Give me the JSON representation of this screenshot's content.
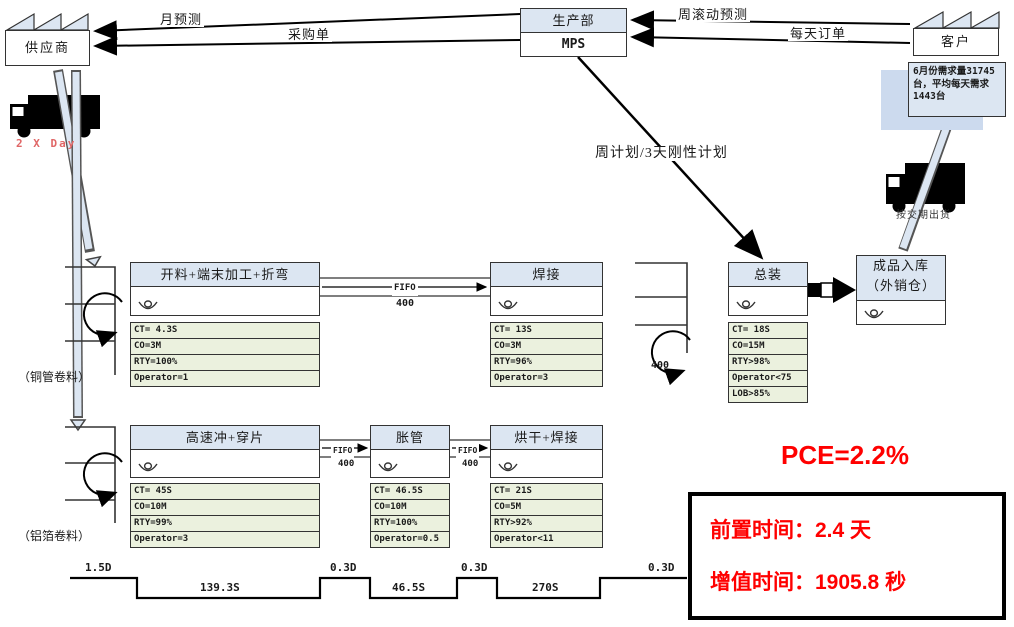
{
  "entities": {
    "supplier": "供应商",
    "production_dept": "生产部",
    "mps": "MPS",
    "customer": "客户",
    "demand_note": "6月份需求量31745台，平均每天需求1443台",
    "warehouse_line1": "成品入库",
    "warehouse_line2": "（外销仓）"
  },
  "flows": {
    "monthly_forecast": "月预测",
    "purchase_order": "采购单",
    "weekly_rolling_forecast": "周滚动预测",
    "daily_order": "每天订单",
    "weekly_plan": "周计划/3天刚性计划",
    "supplier_delivery_freq": "2 X Day",
    "ship_by_due_date": "按交期出货"
  },
  "inventory": {
    "copper_coil": "（铜管卷料）",
    "aluminum_coil": "（铝箔卷料）",
    "loop_qty": "400"
  },
  "fifo": {
    "label": "FIFO",
    "qty": "400"
  },
  "processes": [
    {
      "name": "开料+端末加工+折弯",
      "metrics": [
        "CT= 4.3S",
        "CO=3M",
        "RTY=100%",
        "Operator=1"
      ]
    },
    {
      "name": "焊接",
      "metrics": [
        "CT= 13S",
        "CO=3M",
        "RTY=96%",
        "Operator=3"
      ]
    },
    {
      "name": "总装",
      "metrics": [
        "CT= 18S",
        "CO=15M",
        "RTY>98%",
        "Operator<75",
        "LOB>85%"
      ]
    },
    {
      "name": "高速冲+穿片",
      "metrics": [
        "CT= 45S",
        "CO=10M",
        "RTY=99%",
        "Operator=3"
      ]
    },
    {
      "name": "胀管",
      "metrics": [
        "CT= 46.5S",
        "CO=10M",
        "RTY=100%",
        "Operator=0.5"
      ]
    },
    {
      "name": "烘干+焊接",
      "metrics": [
        "CT= 21S",
        "CO=5M",
        "RTY>92%",
        "Operator<11"
      ]
    }
  ],
  "timeline": {
    "segments": [
      {
        "kind": "wait",
        "label": "1.5D"
      },
      {
        "kind": "process",
        "label": "139.3S"
      },
      {
        "kind": "wait",
        "label": "0.3D"
      },
      {
        "kind": "process",
        "label": "46.5S"
      },
      {
        "kind": "wait",
        "label": "0.3D"
      },
      {
        "kind": "process",
        "label": "270S"
      },
      {
        "kind": "wait",
        "label": "0.3D"
      }
    ]
  },
  "summary": {
    "pce": "PCE=2.2%",
    "lead_time": "前置时间：2.4 天",
    "value_added_time": "增值时间：1905.8 秒"
  },
  "colors": {
    "header_blue": "#dce6f2",
    "data_green": "#ebf1de",
    "accent_red": "#ff0000",
    "truck_label_red": "#e06666"
  }
}
